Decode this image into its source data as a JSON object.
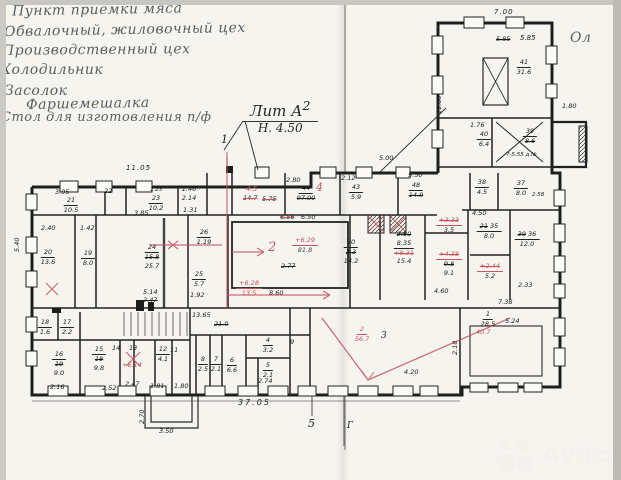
{
  "hand": {
    "l1": "Пункт приемки мяса",
    "l2": "Обвалочный, жиловочный цех",
    "l3": "Производственный цех",
    "l4": "Холодильник",
    "l5": "Засолок",
    "l6": "Фаршемешалка",
    "l7": "Стол для изготовления п/ф",
    "frag": "Ол"
  },
  "title": {
    "lit": "Лит А",
    "sup": "2",
    "h": "Н. 4.50"
  },
  "axis": {
    "n1": "1",
    "n5": "5",
    "g": "Г"
  },
  "wm": {
    "brand": "Avito"
  },
  "plan": {
    "d1105": "11.05",
    "d395": "3.95",
    "d240": "2.40",
    "d142": "1.42",
    "d540": "5.40",
    "d514": "5.14",
    "d247a": "2.47",
    "d192": "1.92",
    "d385": "3.85",
    "d123": "1.23",
    "d146": "1.46",
    "d214": "2.14",
    "d131": "1.31",
    "d280": "2.80",
    "d212": "2.12",
    "d550": "5.50",
    "d500": "5.00",
    "red45": "4.5",
    "d147": "14.7",
    "d575": "5.75",
    "d656": "6.56",
    "d650": "6.50",
    "p629": "+6.29",
    "a818": "81.8",
    "red2big": "2",
    "d277": "2.77",
    "d860": "8.60",
    "p628": "+6.28",
    "red135": "13.5",
    "d460": "4.60",
    "d450": "4.50",
    "d233": "2.33",
    "d738": "7.38",
    "d524": "5.24",
    "d218": "2.18",
    "d420": "4.20",
    "d700": "7.00",
    "d585a": "5.85",
    "d585b": "5.85",
    "d176": "1.76",
    "d180ap": "1.80",
    "d1180": "11.80",
    "d1365": "13.65",
    "d210c": "21.0",
    "d216": "2.16",
    "d252": "2.52",
    "d247b": "2.47",
    "d181": "1.81",
    "d180b": "1.80",
    "d3705": "37.05",
    "d350": "3.50",
    "d270": "2.70",
    "p614": "+6.14",
    "d274": "2.74",
    "d258": "2.58",
    "note39": "7-5.55 д.№",
    "r21n": "21",
    "r21a": "10.5",
    "r22": "22",
    "r23n": "23",
    "r23a": "10.2",
    "r20n": "20",
    "r20a": "13.6",
    "r19n": "19",
    "r19a": "8.0",
    "r24n": "24",
    "r24old": "15.8",
    "r24a": "25.7",
    "r26n": "26",
    "r26a": "1.19",
    "r25n": "25",
    "r25a": "5.7",
    "r44n": "44",
    "r44old": "97.00",
    "red4big": "4",
    "r43n": "43",
    "r43a": "5.9",
    "r48n": "48",
    "r48old": "14.9",
    "r30n": "30",
    "r30old": "2.3",
    "r30a": "14.2",
    "r31old": "2.80",
    "r31n": "8.35",
    "r31red": "+8.31",
    "r31a": "15.4",
    "r32redA": "+3.33",
    "r32a1": "3.5",
    "r32redB": "+4.38",
    "r32old": "9.8",
    "r32a2": "9.1",
    "r35old": "21",
    "r35n": "35",
    "r35a": "8.0",
    "r34red": "+2.44",
    "r34a": "5.2",
    "r36old": "39",
    "r36n": "36",
    "r36a": "12.0",
    "r38n": "38",
    "r38a": "4.5",
    "r37n": "37",
    "r37a": "8.0",
    "r41n": "41",
    "r41a": "31.6",
    "r40n": "40",
    "r40a": "6.4",
    "r39n": "39",
    "r39a": "8.6",
    "r16n": "16",
    "r16old": "19",
    "r16a": "9.0",
    "r15n": "15",
    "r15old": "18",
    "r15a": "9.8",
    "r14": "14",
    "r13": "13",
    "r12n": "12",
    "r12a": "4.1",
    "r11": "11",
    "r9": "9",
    "r8n": "8",
    "r8a": "2.5",
    "r7n": "7",
    "r7a": "2.1",
    "r6n": "6",
    "r6a": "6.6",
    "r5n": "5",
    "r5a": "2.1",
    "r4n": "4",
    "r4a": "3.2",
    "r3": "3",
    "r1n": "1",
    "r1a": "28.5",
    "r1red": "40.7",
    "red2f": "2",
    "red567": "56.7",
    "r18n": "18",
    "r18a": "1.6",
    "r17n": "17",
    "r17a": "2.2"
  }
}
